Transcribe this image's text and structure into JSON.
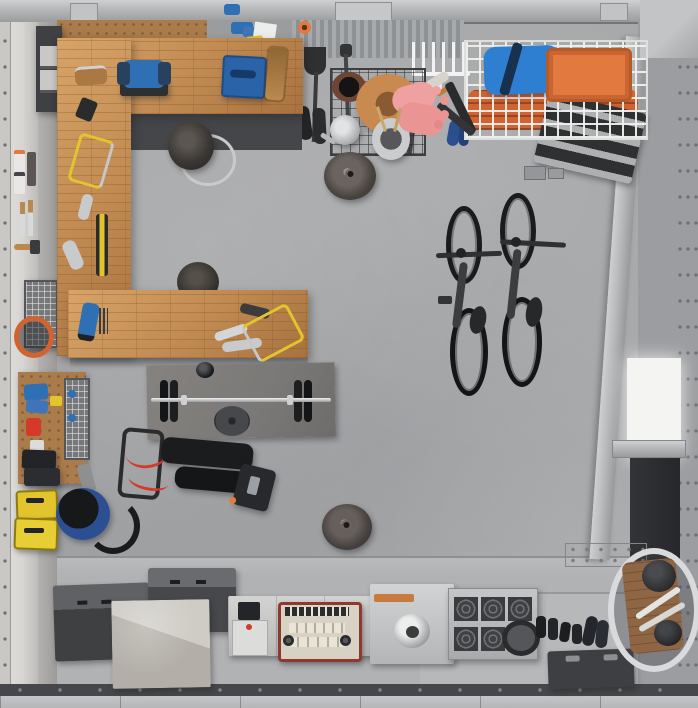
{
  "scene": {
    "title": "Garage workshop and home gym, overhead top-down 3D render",
    "view": "top-down",
    "room_type": "garage",
    "visible_text": "",
    "item_counts": {
      "bicycles": 2,
      "pendant_lamps": 2,
      "shop_stools": 2,
      "yellow_hacksaws": 2
    }
  },
  "palette": {
    "floor": "#a6a7a9",
    "floor_apron": "#b1b2b4",
    "beam": "#b8b9bb",
    "left_wall": "#d6d5d2",
    "door": "#b5b6b8",
    "track": "#46474a",
    "wood": "#c08a52",
    "pegboard": "#aa7c4c",
    "cabinet_dark": "#45464a",
    "equip_black": "#232427",
    "mat": "#7b7977",
    "accent_red": "#d43a2a",
    "blue": "#2f6fb4",
    "blue_bag": "#2e7fd2",
    "orange": "#e2793f",
    "orange_roll": "#d2622f",
    "yellow": "#e2c52c",
    "pink": "#efa0a0",
    "terracotta": "#c98a50",
    "chrome": "#d9dadc",
    "vac_blue": "#2c4f94",
    "white_panel": "#f4f4f2"
  },
  "objects": {
    "room": "Garage interior seen from directly above",
    "top_beam": "Steel ceiling beam across top wall",
    "left_wall": "White paneled side wall",
    "right_wall": "Steel framed right wall with diagonal brace",
    "garage_door": "Sectional garage door along bottom edge",
    "workbench": "C-shaped butcher-block workbench",
    "under_bench_cabinet": "Dark cabinet under workbench",
    "tool_cabinet": "Dark drawer cabinet in top-left corner",
    "bench_grinder": "Blue bench grinder",
    "systainer_case": "Blue stacking tool case",
    "wood_clamp": "Long wooden hand-screw clamp",
    "hand_plane": "Wooden hand plane",
    "drill": "Black power drill",
    "hacksaw_1": "Yellow hacksaw on left bench arm",
    "hacksaw_2": "Yellow hacksaw on bottom bench arm",
    "wrenches": "Assorted chrome wrenches",
    "spirit_level": "Black and yellow spirit level",
    "jigsaw": "Blue jigsaw",
    "stool_1": "Round shop stool with chrome footring",
    "stool_2": "Second shop stool tucked under bench",
    "pegboard_top": "Pegboard strip above workbench",
    "pegboard_lower": "Pegboard tool panel, lower left",
    "spray_cans": "Spray cans with orange caps on wall",
    "chisels": "Wood-handled chisels on wall",
    "mallet": "Mallet on wall rail",
    "wire_baskets": "Stacked wire parts baskets",
    "hose_coil": "Coiled orange air hose",
    "oil_can": "Red oil can",
    "black_cases": "Stacked black tool cases",
    "yellow_cases": "Stacked yellow tool boxes",
    "shop_vac": "Blue wet/dry shop vacuum with hose",
    "gym_mat": "Gray rubber gym mat",
    "barbell": "Barbell with black plates",
    "weight_plate": "Loose weight plate on mat",
    "small_plate": "Small black weight disc",
    "weight_bench": "Folding weight bench, black with red frame",
    "pendant_lamp_1": "Dome pendant lamp (upper)",
    "pendant_lamp_2": "Dome pendant lamp (lower)",
    "garden_cart": "Wire mesh garden cart",
    "terracotta_pot": "Terracotta plant pot",
    "dark_pot": "Dark plant pot",
    "garden_gloves": "Pink garden gloves",
    "watering_can": "Galvanized watering can",
    "plant_bucket": "Metal bucket with dried stems",
    "garden_tools": "Hanging shovel and hoe",
    "white_rake": "White fan rake hanging on wall",
    "paint_roller": "Paint roller",
    "boots": "Pair of dark boots",
    "spade": "Spade leaning on wall",
    "blue_shoes": "Blue shoes",
    "overhead_rack": "White wire overhead storage rack",
    "duffel_bag": "Blue duffel bag in rack",
    "orange_crate": "Orange lidded crate in rack",
    "orange_rolls": "Rolled orange mats in rack",
    "step_shelf": "Dark ladder-style wall shelf",
    "bike_1": "Bicycle (left)",
    "bike_2": "Bicycle (right)",
    "wall_bracket": "Bolted wall bracket plate",
    "storage_box_dark_1": "Dark storage chest",
    "storage_box_dark_2": "Second dark storage chest",
    "concrete_block": "Concrete-toned storage block",
    "white_unit": "White appliance cabinet",
    "vintage_radio": "Red and cream vintage radio",
    "silver_machine": "Metal machine with round port",
    "speaker_unit": "Unit with six round speaker grilles",
    "dumbbells": "Small dumbbells and shoes on floor",
    "floor_plate": "Round weight plate on floor",
    "dark_case": "Dark case with two handles",
    "corner_cart": "Garden cart wheel with helmets, bottom-right corner",
    "white_bright_panel": "Bright white panel on right wall",
    "dark_panel": "Dark panel on right wall"
  }
}
